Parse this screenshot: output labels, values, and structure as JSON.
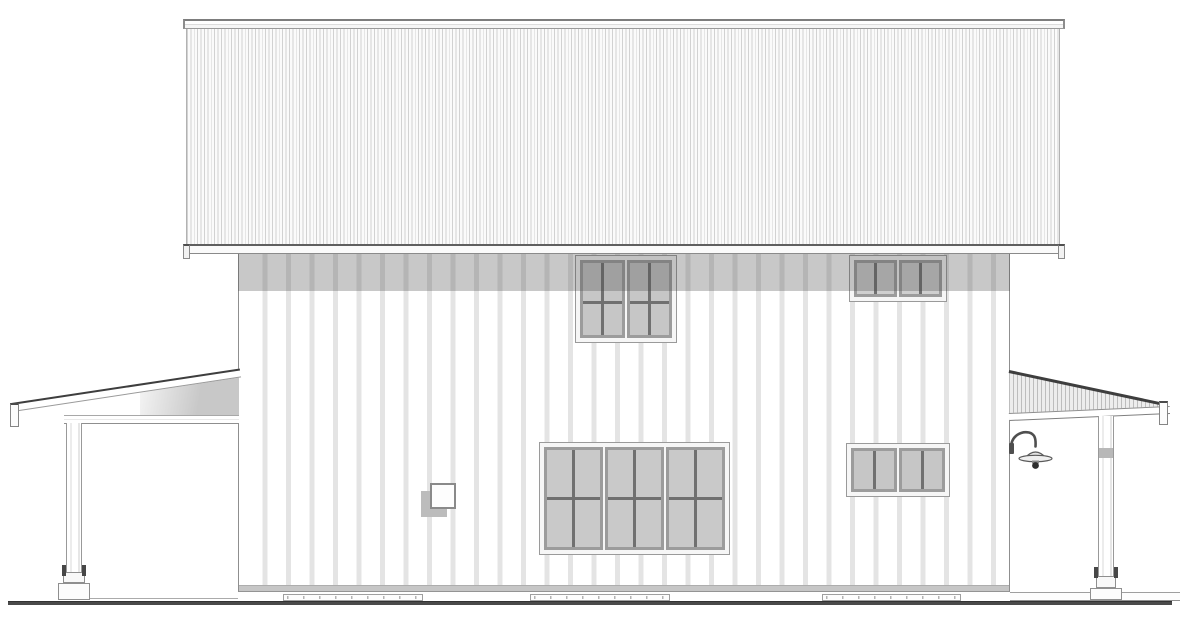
{
  "scene": {
    "type": "architectural-elevation-drawing",
    "view": "side-elevation",
    "description": "Two-story house side elevation with standing-seam roof, board-and-batten siding, shed-roof porch on each side"
  },
  "colors": {
    "line_dark": "#3e3e3e",
    "line": "#8f8f8f",
    "roof_line": "#d2d2d2",
    "roof_bg": "#fbfbfb",
    "batten": "#e4e4e4",
    "frame": "#f6f6f6",
    "frame_line": "#9a9a9a",
    "sash": "#9c9c9c",
    "muntin": "#707070",
    "shadow": "rgba(72,72,72,0.30)",
    "base_band": "#c6c6c6",
    "ground": "#4a4a4a",
    "soffit": "#c8c8c8",
    "hatch": "#bdbdbd",
    "fixture": "#4f4f4f"
  },
  "windows": [
    {
      "id": "upper-left",
      "sashes": 2,
      "cols": 2,
      "rows": 2,
      "hbar_pct": 55,
      "glass": "#c6c6c6"
    },
    {
      "id": "upper-right",
      "sashes": 2,
      "cols": 2,
      "rows": 1,
      "hbar_pct": 50,
      "glass": "#cfcfcf"
    },
    {
      "id": "main-floor",
      "sashes": 3,
      "cols": 2,
      "rows": 2,
      "hbar_pct": 50,
      "glass": "#c9c9c9"
    },
    {
      "id": "lower-right",
      "sashes": 2,
      "cols": 2,
      "rows": 1,
      "hbar_pct": 50,
      "glass": "#c6c6c6"
    }
  ],
  "elements": [
    "ridge-cap",
    "roof-surface",
    "eave-fascia",
    "wall-siding",
    "eave-shadow",
    "window-upper-left",
    "window-upper-right",
    "window-main-floor",
    "window-lower-right",
    "wall-vent",
    "gooseneck-light",
    "left-porch-roof",
    "left-porch-beam",
    "left-porch-post",
    "left-porch-post-base",
    "right-porch-roof",
    "right-porch-fascia",
    "right-porch-post",
    "right-porch-post-base",
    "right-porch-slab",
    "foundation-pads",
    "ground-line"
  ]
}
